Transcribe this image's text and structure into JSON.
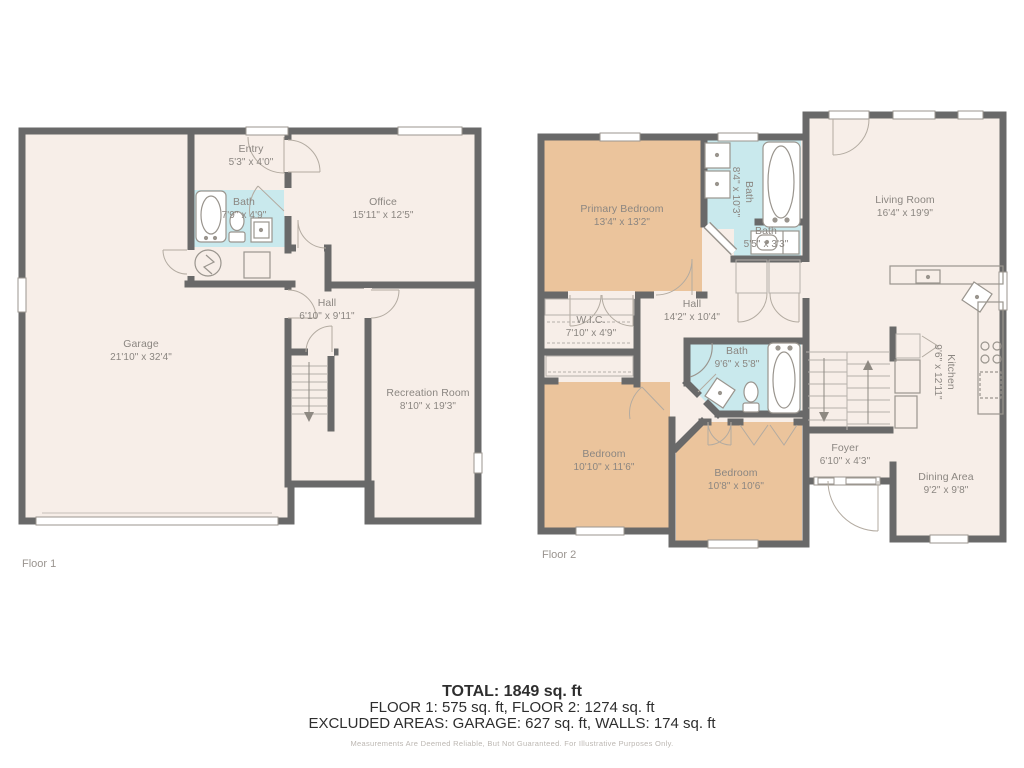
{
  "colors": {
    "floor": "#f7eee8",
    "bedroom_fill": "#ebc49c",
    "bath_fill": "#c9e9ed",
    "wall": "#696969",
    "label_text": "#8b8681",
    "summary_text": "#2e2e2e"
  },
  "floor1": {
    "label": "Floor 1",
    "rooms": {
      "garage": {
        "name": "Garage",
        "dims": "21'10\" x 32'4\""
      },
      "entry": {
        "name": "Entry",
        "dims": "5'3\" x 4'0\""
      },
      "bath": {
        "name": "Bath",
        "dims": "7'9\" x 4'9\""
      },
      "office": {
        "name": "Office",
        "dims": "15'11\" x 12'5\""
      },
      "hall": {
        "name": "Hall",
        "dims": "6'10\" x 9'11\""
      },
      "recreation": {
        "name": "Recreation Room",
        "dims": "8'10\" x 19'3\""
      }
    }
  },
  "floor2": {
    "label": "Floor 2",
    "rooms": {
      "primary": {
        "name": "Primary Bedroom",
        "dims": "13'4\" x 13'2\""
      },
      "bath_primary": {
        "name": "Bath",
        "dims": "8'4\" x 10'3\""
      },
      "bath_small": {
        "name": "Bath",
        "dims": "5'5\" x 3'3\""
      },
      "living": {
        "name": "Living Room",
        "dims": "16'4\" x 19'9\""
      },
      "wic": {
        "name": "W.I.C.",
        "dims": "7'10\" x 4'9\""
      },
      "hall": {
        "name": "Hall",
        "dims": "14'2\" x 10'4\""
      },
      "bath_hall": {
        "name": "Bath",
        "dims": "9'6\" x 5'8\""
      },
      "bedroom_a": {
        "name": "Bedroom",
        "dims": "10'10\" x 11'6\""
      },
      "bedroom_b": {
        "name": "Bedroom",
        "dims": "10'8\" x 10'6\""
      },
      "foyer": {
        "name": "Foyer",
        "dims": "6'10\" x 4'3\""
      },
      "kitchen": {
        "name": "Kitchen",
        "dims": "9'6\" x 12'11\""
      },
      "dining": {
        "name": "Dining Area",
        "dims": "9'2\" x 9'8\""
      }
    }
  },
  "summary": {
    "total": "TOTAL: 1849 sq. ft",
    "floors": "FLOOR 1: 575 sq. ft, FLOOR 2: 1274 sq. ft",
    "excluded": "EXCLUDED AREAS: GARAGE: 627 sq. ft, WALLS: 174 sq. ft",
    "disclaimer": "Measurements Are Deemed Reliable, But Not Guaranteed. For Illustrative Purposes Only."
  }
}
